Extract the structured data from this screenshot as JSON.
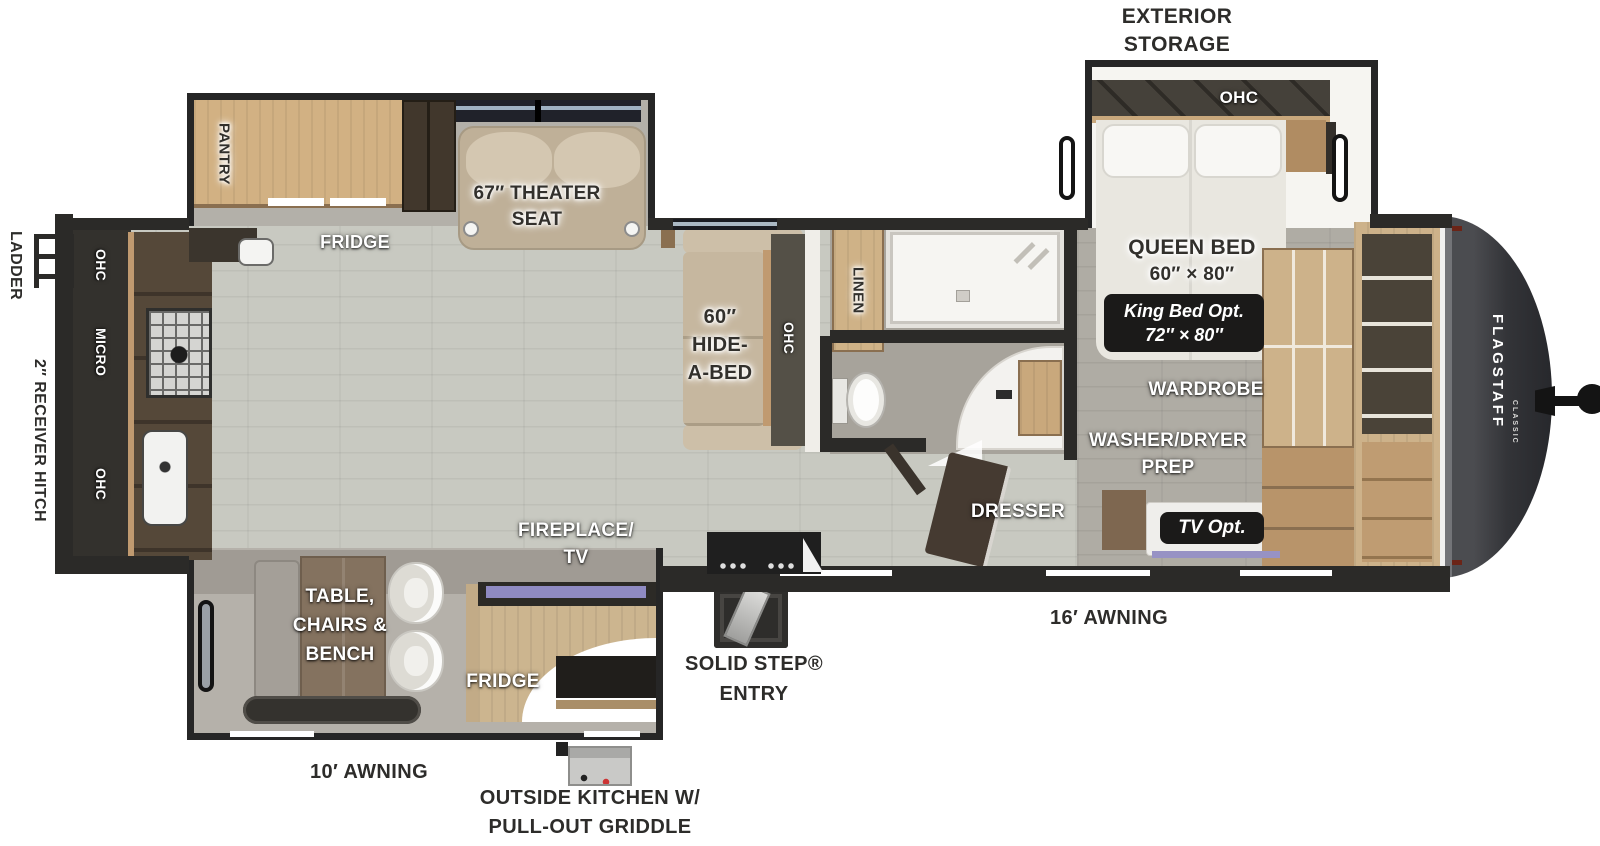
{
  "title": "Flagstaff Classic travel trailer floor plan",
  "brand": {
    "name": "FLAGSTAFF",
    "series": "CLASSIC"
  },
  "exterior": {
    "storage_l1": "EXTERIOR",
    "storage_l2": "STORAGE",
    "ladder": "LADDER",
    "hitch": "2″ RECEIVER HITCH",
    "awning16": "16′ AWNING",
    "awning10": "10′ AWNING",
    "step_l1": "SOLID STEP®",
    "step_l2": "ENTRY",
    "outkitchen_l1": "OUTSIDE KITCHEN W/",
    "outkitchen_l2": "PULL-OUT GRIDDLE"
  },
  "bedroom": {
    "ohc": "OHC",
    "queen_l1": "QUEEN BED",
    "queen_l2": "60″ × 80″",
    "king_l1": "King Bed Opt.",
    "king_l2": "72″ × 80″",
    "wardrobe": "WARDROBE",
    "wd_l1": "WASHER/DRYER",
    "wd_l2": "PREP",
    "dresser": "DRESSER",
    "tv_opt": "TV Opt."
  },
  "bath": {
    "linen": "LINEN"
  },
  "living": {
    "hab_l1": "60″",
    "hab_l2": "HIDE-",
    "hab_l3": "A-BED",
    "hab_ohc": "OHC",
    "theater_l1": "67″ THEATER",
    "theater_l2": "SEAT",
    "fridge": "FRIDGE",
    "pantry": "PANTRY"
  },
  "dinette": {
    "l1": "TABLE,",
    "l2": "CHAIRS &",
    "l3": "BENCH",
    "fireplace_l1": "FIREPLACE/",
    "fireplace_l2": "TV",
    "fridge": "FRIDGE"
  },
  "kitchen": {
    "ohc1": "OHC",
    "micro": "MICRO",
    "ohc2": "OHC"
  },
  "colors": {
    "wall": "#2b2a28",
    "wood": "#cdb28a",
    "screen_accent": "#918cc4",
    "floor_main": "#c8c9c1",
    "floor_bedroom": "#afaca4",
    "cap": "#333438"
  }
}
